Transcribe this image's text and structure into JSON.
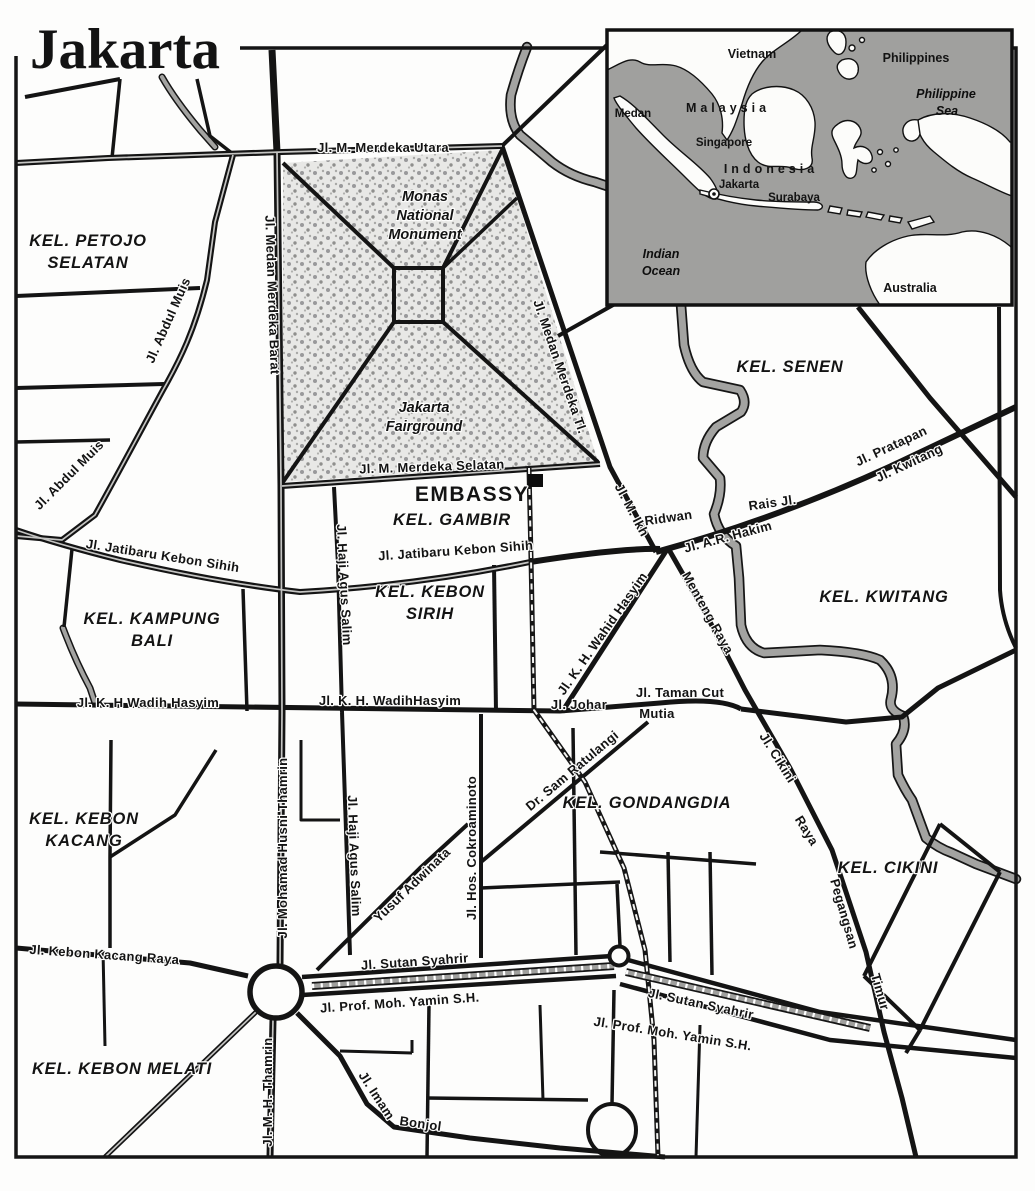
{
  "title": "Jakarta",
  "map": {
    "embassy": "EMBASSY",
    "monas": [
      "Monas",
      "National",
      "Monument"
    ],
    "fairground": [
      "Jakarta",
      "Fairground"
    ],
    "districts": [
      {
        "lines": [
          "KEL. PETOJO",
          "SELATAN"
        ]
      },
      {
        "lines": [
          "KEL. SENEN"
        ]
      },
      {
        "lines": [
          "KEL. GAMBIR"
        ]
      },
      {
        "lines": [
          "KEL. KAMPUNG",
          "BALI"
        ]
      },
      {
        "lines": [
          "KEL. KEBON",
          "SIRIH"
        ]
      },
      {
        "lines": [
          "KEL. KWITANG"
        ]
      },
      {
        "lines": [
          "KEL. GONDANGDIA"
        ]
      },
      {
        "lines": [
          "KEL. KEBON",
          "KACANG"
        ]
      },
      {
        "lines": [
          "KEL. CIKINI"
        ]
      },
      {
        "lines": [
          "KEL. KEBON MELATI"
        ]
      }
    ],
    "streets": [
      "Jl. M. Merdeka Utara",
      "Jl. Medan Merdeka Barat",
      "Jl. Abdul Muis",
      "Jl. Abdul Muis",
      "Jl. M. Merdeka Selatan",
      "Jl. Medan Merdeka Tl.",
      "Jl. M. Ikh",
      "Ridwan",
      "Rais Jl.",
      "Jl. A.R. Hakim",
      "Jl. Pratapan",
      "Jl. Kwitang",
      "Jl. Jatibaru Kebon Sihih",
      "Jl. Jatibaru Kebon Sihih",
      "Jl. Haji Agus Salim",
      "Jl. K. H Wadih Hasyim",
      "Jl. K. H. WadihHasyim",
      "Jl. K. H. Wahid Hasyim",
      "Jl. Johar",
      "Jl. Taman Cut",
      "Mutia",
      "Menteng Raya",
      "Dr. Sam Ratulangi",
      "Jl. Hos. Cokroaminoto",
      "Yusuf Adwinata",
      "Jl. Haji Agus Salim",
      "Jl. Cikini",
      "Raya",
      "Pegangsan",
      "Timur",
      "Jl. Mohamad Husni Thamrin",
      "Jl. Kebon Kacang Raya",
      "Jl. Sutan Syahrir",
      "Jl. Prof. Moh. Yamin S.H.",
      "Jl. Sutan Syahrir",
      "Jl. Prof. Moh. Yamin S.H.",
      "Jl. M. H. Thamrin",
      "Jl. Imam",
      "Bonjol"
    ]
  },
  "inset": {
    "countries": [
      "Vietnam",
      "Philippines",
      "Malaysia",
      "Indonesia",
      "Australia"
    ],
    "cities": [
      "Medan",
      "Singapore",
      "Jakarta",
      "Surabaya"
    ],
    "seas": [
      "Philippine",
      "Sea",
      "Indian",
      "Ocean"
    ]
  },
  "colors": {
    "road": "#141414",
    "river": "#a3a3a1",
    "sea": "#a0a09e",
    "park_dot": "#9a9a98",
    "paper": "#fdfdfc"
  }
}
